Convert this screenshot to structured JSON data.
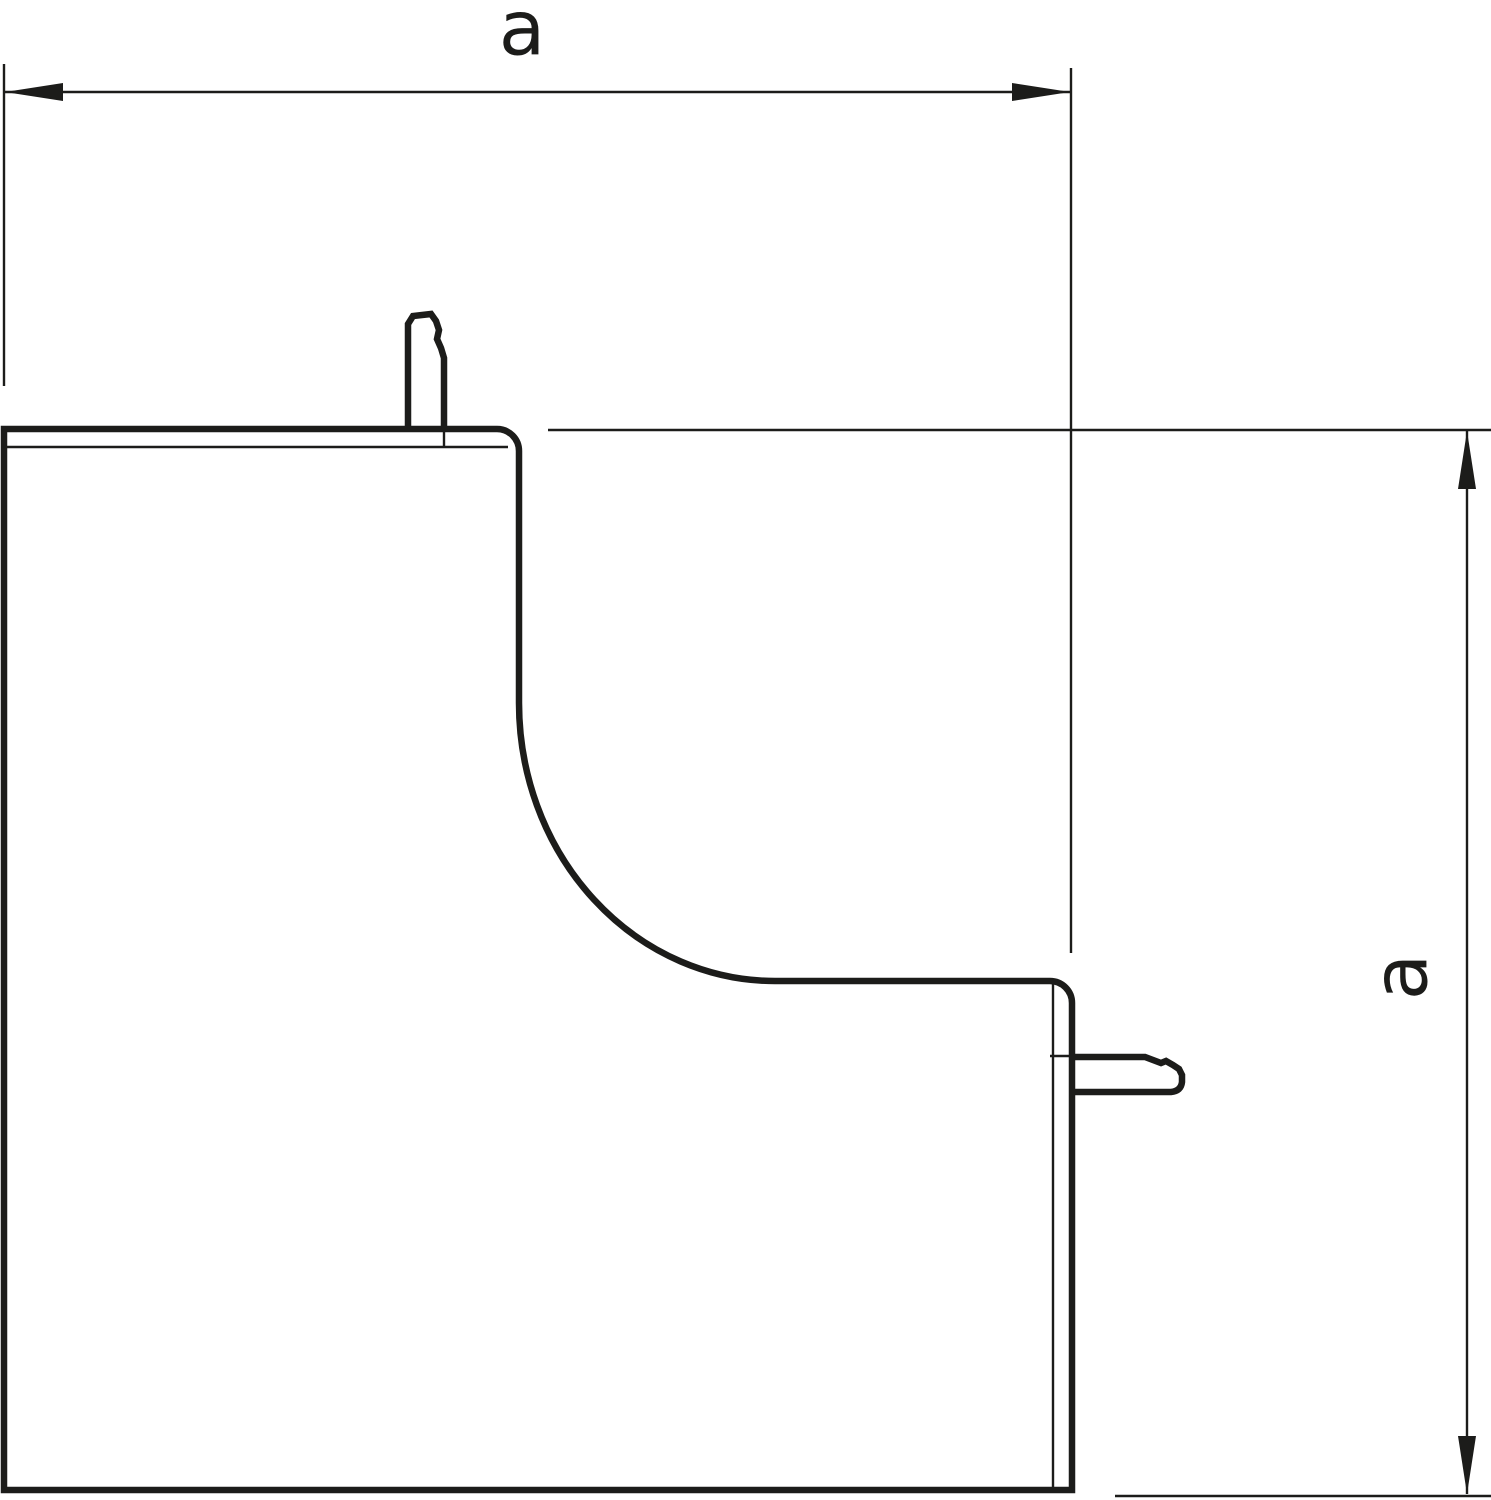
{
  "drawing": {
    "background_color": "#ffffff",
    "line_color": "#1c1c1a"
  },
  "dimensions": {
    "horizontal": {
      "label": "a"
    },
    "vertical": {
      "label": "a"
    }
  }
}
